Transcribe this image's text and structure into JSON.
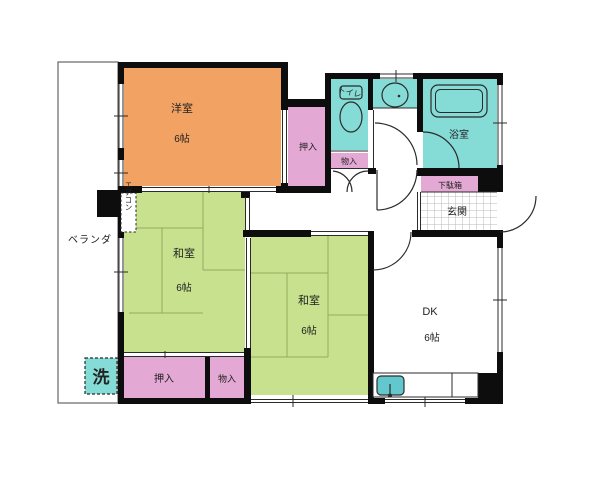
{
  "palette": {
    "wall": "#0d0d0d",
    "line": "#2b2b2b",
    "orange": "#F2A263",
    "green": "#C7E18E",
    "tatami": "#93AC60",
    "pink": "#E3A8D3",
    "cyan": "#85DBD6",
    "sink": "#62C8CE",
    "tile": "#b9b9b9",
    "text": "#222222"
  },
  "rooms": {
    "veranda": {
      "label": "ベランダ"
    },
    "washing_machine": {
      "label": "洗"
    },
    "air_conditioner": {
      "label": "エアコン"
    },
    "western_room": {
      "label": "洋室",
      "size": "6帖"
    },
    "closet_west": {
      "label": "押入"
    },
    "toilet": {
      "label": "トイレ"
    },
    "storage_north": {
      "label": "物入"
    },
    "bathroom": {
      "label": "浴室"
    },
    "shoe_cabinet": {
      "label": "下駄箱"
    },
    "entrance": {
      "label": "玄関"
    },
    "japanese_room_west": {
      "label": "和室",
      "size": "6帖"
    },
    "japanese_room_south": {
      "label": "和室",
      "size": "6帖"
    },
    "dining_kitchen": {
      "label": "DK",
      "size": "6帖"
    },
    "closet_south": {
      "label": "押入"
    },
    "storage_south": {
      "label": "物入"
    }
  }
}
